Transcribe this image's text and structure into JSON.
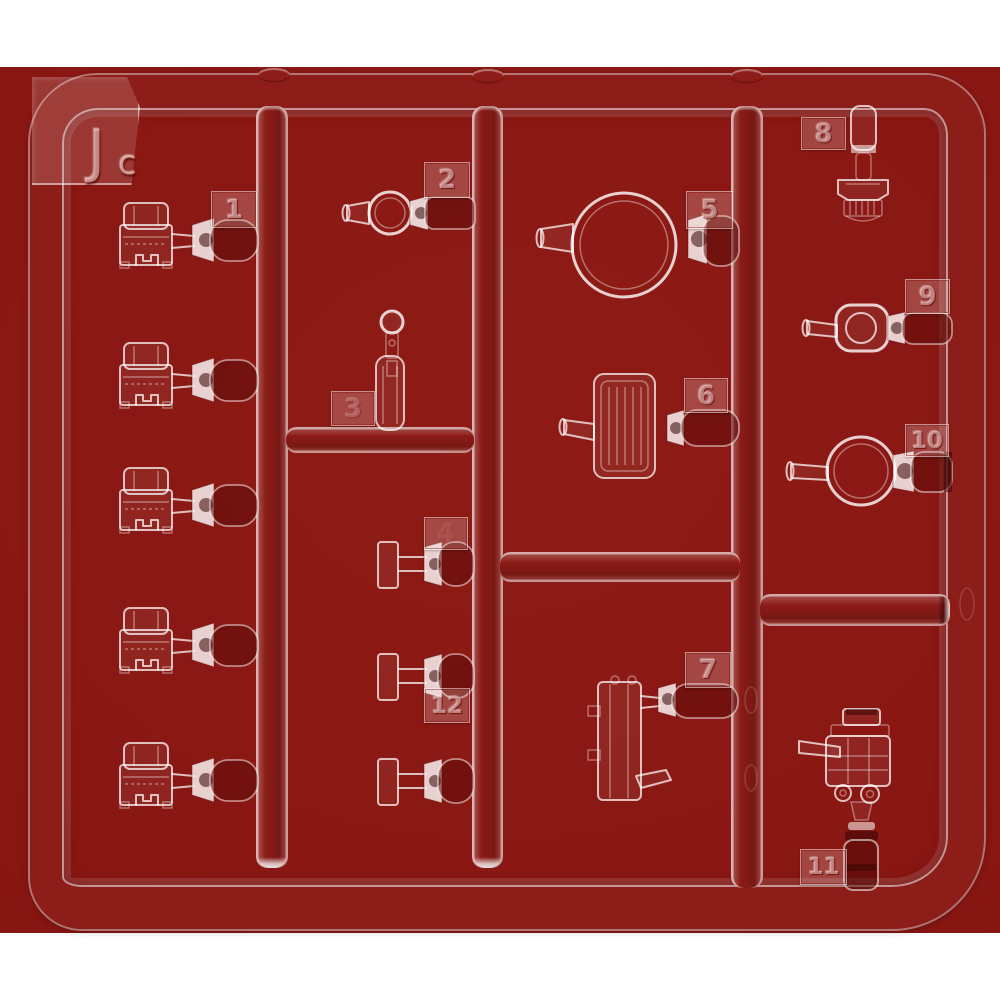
{
  "photo": {
    "background_color": "#881612",
    "page_background": "#ffffff",
    "plastic_highlight": "#ffffff",
    "frame_color": "#8d1d18"
  },
  "sprue": {
    "label": {
      "letter": "J",
      "sub": "c"
    },
    "tags": [
      {
        "id": "tag-1",
        "label": "1"
      },
      {
        "id": "tag-2",
        "label": "2"
      },
      {
        "id": "tag-3",
        "label": "3"
      },
      {
        "id": "tag-4",
        "label": "4"
      },
      {
        "id": "tag-5",
        "label": "5"
      },
      {
        "id": "tag-6",
        "label": "6"
      },
      {
        "id": "tag-7",
        "label": "7"
      },
      {
        "id": "tag-8",
        "label": "8"
      },
      {
        "id": "tag-9",
        "label": "9"
      },
      {
        "id": "tag-10",
        "label": "10"
      },
      {
        "id": "tag-11",
        "label": "11"
      },
      {
        "id": "tag-12",
        "label": "12"
      }
    ]
  }
}
